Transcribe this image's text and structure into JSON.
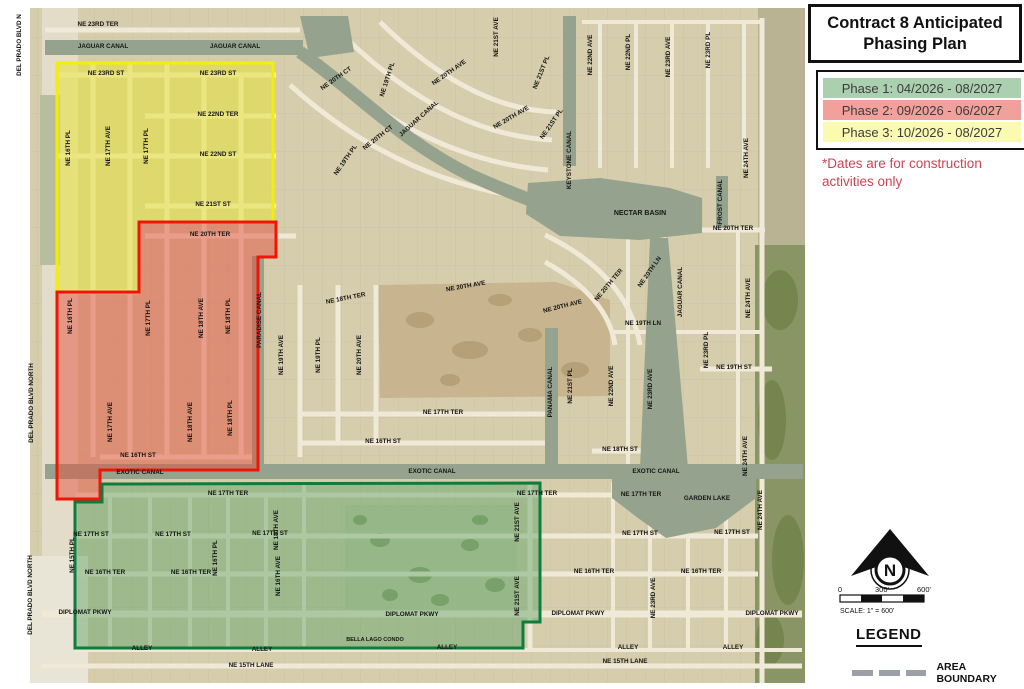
{
  "title": {
    "line1": "Contract 8 Anticipated",
    "line2": "Phasing Plan"
  },
  "phases": [
    {
      "label": "Phase 1: 04/2026 - 08/2027",
      "color": "#abd0af"
    },
    {
      "label": "Phase 2: 09/2026 - 06/2027",
      "color": "#f2a09c"
    },
    {
      "label": "Phase 3: 10/2026 - 08/2027",
      "color": "#fafab0"
    }
  ],
  "note": {
    "line1": "*Dates are for construction",
    "line2": "activities only",
    "color": "#cc4455"
  },
  "compass": {
    "letter": "N"
  },
  "scale": {
    "tick0": "0",
    "tick1": "300'",
    "tick2": "600'",
    "caption": "SCALE: 1\" = 600'"
  },
  "legend": {
    "heading": "LEGEND",
    "area_boundary": "AREA BOUNDARY"
  },
  "map": {
    "colors": {
      "base": "#d5cdab",
      "road": "#f0e9d7",
      "water": "#95a28d",
      "label": "#151515",
      "grid": "#c9c0a2"
    },
    "terrain": [
      {
        "t": "rect",
        "x": 42,
        "y": 8,
        "w": 36,
        "h": 675,
        "f": "#e3dcc8"
      },
      {
        "t": "rect",
        "x": 40,
        "y": 95,
        "w": 20,
        "h": 170,
        "f": "#b7bd9f"
      },
      {
        "t": "rect",
        "x": 30,
        "y": 556,
        "w": 58,
        "h": 127,
        "f": "#e8e4d6"
      },
      {
        "t": "rect",
        "x": 758,
        "y": 8,
        "w": 47,
        "h": 675,
        "f": "#b9b394"
      },
      {
        "t": "rect",
        "x": 755,
        "y": 245,
        "w": 50,
        "h": 438,
        "f": "#8a9565"
      },
      {
        "t": "ell",
        "x": 780,
        "y": 300,
        "rx": 18,
        "ry": 30,
        "f": "#75854e"
      },
      {
        "t": "ell",
        "x": 772,
        "y": 420,
        "rx": 14,
        "ry": 40,
        "f": "#75854e"
      },
      {
        "t": "ell",
        "x": 788,
        "y": 560,
        "rx": 16,
        "ry": 45,
        "f": "#75854e"
      },
      {
        "t": "ell",
        "x": 770,
        "y": 640,
        "rx": 14,
        "ry": 25,
        "f": "#75854e"
      },
      {
        "t": "poly",
        "p": "378,285 556,282 610,300 610,396 380,398",
        "f": "#c8b48e"
      },
      {
        "t": "ell",
        "x": 420,
        "y": 320,
        "rx": 14,
        "ry": 8,
        "f": "#b5a078"
      },
      {
        "t": "ell",
        "x": 470,
        "y": 350,
        "rx": 18,
        "ry": 9,
        "f": "#b5a078"
      },
      {
        "t": "ell",
        "x": 530,
        "y": 335,
        "rx": 12,
        "ry": 7,
        "f": "#b5a078"
      },
      {
        "t": "ell",
        "x": 575,
        "y": 370,
        "rx": 14,
        "ry": 8,
        "f": "#b5a078"
      },
      {
        "t": "ell",
        "x": 450,
        "y": 380,
        "rx": 10,
        "ry": 6,
        "f": "#b5a078"
      },
      {
        "t": "ell",
        "x": 500,
        "y": 300,
        "rx": 12,
        "ry": 6,
        "f": "#b5a078"
      },
      {
        "t": "rect",
        "x": 345,
        "y": 505,
        "w": 172,
        "h": 105,
        "f": "#c6c8a4"
      },
      {
        "t": "ell",
        "x": 380,
        "y": 540,
        "rx": 10,
        "ry": 7,
        "f": "#8ea06e"
      },
      {
        "t": "ell",
        "x": 420,
        "y": 575,
        "rx": 12,
        "ry": 8,
        "f": "#8ea06e"
      },
      {
        "t": "ell",
        "x": 470,
        "y": 545,
        "rx": 9,
        "ry": 6,
        "f": "#8ea06e"
      },
      {
        "t": "ell",
        "x": 390,
        "y": 595,
        "rx": 8,
        "ry": 6,
        "f": "#8ea06e"
      },
      {
        "t": "ell",
        "x": 495,
        "y": 585,
        "rx": 10,
        "ry": 7,
        "f": "#8ea06e"
      },
      {
        "t": "ell",
        "x": 360,
        "y": 520,
        "rx": 7,
        "ry": 5,
        "f": "#8ea06e"
      },
      {
        "t": "ell",
        "x": 440,
        "y": 600,
        "rx": 9,
        "ry": 6,
        "f": "#8ea06e"
      },
      {
        "t": "ell",
        "x": 480,
        "y": 520,
        "rx": 8,
        "ry": 5,
        "f": "#8ea06e"
      }
    ],
    "water": [
      {
        "t": "rect",
        "x": 45,
        "y": 40,
        "w": 258,
        "h": 15
      },
      {
        "t": "poly",
        "p": "300,16 348,16 354,52 310,58"
      },
      {
        "t": "path",
        "d": "M300,52 C360,95 400,140 470,175 C510,193 538,203 562,212",
        "sw": 13
      },
      {
        "t": "rect",
        "x": 563,
        "y": 16,
        "w": 13,
        "h": 150
      },
      {
        "t": "poly",
        "p": "528,183 600,178 670,188 702,198 702,233 640,240 560,236 526,214"
      },
      {
        "t": "rect",
        "x": 716,
        "y": 176,
        "w": 12,
        "h": 52
      },
      {
        "t": "poly",
        "p": "650,238 668,238 688,468 640,468"
      },
      {
        "t": "rect",
        "x": 545,
        "y": 328,
        "w": 13,
        "h": 142
      },
      {
        "t": "rect",
        "x": 252,
        "y": 256,
        "w": 12,
        "h": 214
      },
      {
        "t": "rect",
        "x": 45,
        "y": 464,
        "w": 758,
        "h": 15
      },
      {
        "t": "poly",
        "p": "612,479 756,479 756,498 716,528 666,538 638,518 612,498"
      }
    ],
    "roads": {
      "h": [
        [
          30,
          45,
          300
        ],
        [
          75,
          57,
          276
        ],
        [
          116,
          145,
          276
        ],
        [
          156,
          57,
          276
        ],
        [
          206,
          145,
          276
        ],
        [
          236,
          145,
          296
        ],
        [
          292,
          57,
          139
        ],
        [
          457,
          100,
          258
        ],
        [
          495,
          75,
          668
        ],
        [
          536,
          75,
          758
        ],
        [
          574,
          75,
          758
        ],
        [
          614,
          42,
          802,
          7
        ],
        [
          650,
          75,
          802,
          4
        ],
        [
          666,
          42,
          802
        ],
        [
          443,
          298,
          545
        ],
        [
          414,
          298,
          545
        ],
        [
          369,
          700,
          772
        ],
        [
          451,
          592,
          658
        ],
        [
          230,
          700,
          765
        ],
        [
          22,
          582,
          760,
          4
        ],
        [
          332,
          613,
          762,
          4
        ]
      ],
      "v": [
        [
          93,
          63,
          457
        ],
        [
          130,
          63,
          457
        ],
        [
          167,
          63,
          457
        ],
        [
          204,
          75,
          457
        ],
        [
          241,
          75,
          457
        ],
        [
          300,
          285,
          457
        ],
        [
          338,
          285,
          443
        ],
        [
          376,
          285,
          443
        ],
        [
          110,
          495,
          648,
          4
        ],
        [
          150,
          495,
          648,
          4
        ],
        [
          190,
          495,
          648,
          4
        ],
        [
          228,
          495,
          648,
          4
        ],
        [
          266,
          495,
          648,
          4
        ],
        [
          304,
          482,
          648,
          4
        ],
        [
          530,
          482,
          650
        ],
        [
          613,
          482,
          650,
          4
        ],
        [
          650,
          482,
          650,
          4
        ],
        [
          688,
          482,
          650,
          4
        ],
        [
          726,
          482,
          650,
          4
        ],
        [
          600,
          22,
          168,
          4
        ],
        [
          636,
          22,
          168,
          4
        ],
        [
          672,
          22,
          168,
          4
        ],
        [
          708,
          22,
          168,
          4
        ],
        [
          744,
          22,
          168,
          4
        ],
        [
          628,
          230,
          466,
          4
        ],
        [
          664,
          230,
          466,
          4
        ],
        [
          738,
          230,
          466,
          4
        ],
        [
          762,
          18,
          683,
          5
        ]
      ],
      "d": [
        "M290,85 Q400,185 545,200",
        "M318,62 Q425,160 548,170",
        "M348,40 Q448,135 552,140",
        "M380,22 Q470,110 556,112",
        "M545,235 Q628,275 640,345",
        "M545,262 Q608,297 615,345"
      ]
    },
    "zones": [
      {
        "name": "phase3-yellow",
        "path": "M57,63 L273,63 L273,222 L139,222 L139,292 L57,292 Z",
        "fill": "#e8e33a",
        "op": 0.55,
        "stroke": "#f4ef00"
      },
      {
        "name": "phase2-red",
        "path": "M139,222 L276,222 L276,257 L258,257 L258,470 L100,470 L100,499 L57,499 L57,292 L139,292 Z",
        "fill": "#e4523f",
        "op": 0.5,
        "stroke": "#f01505"
      },
      {
        "name": "phase1-green",
        "path": "M102,484 L540,483 L540,622 L523,622 L523,648 L75,648 L75,502 L102,502 Z",
        "fill": "#5aa263",
        "op": 0.45,
        "stroke": "#0e7c3f"
      }
    ],
    "labels": [
      [
        "NE 23RD TER",
        98,
        26
      ],
      [
        "JAGUAR CANAL",
        103,
        48
      ],
      [
        "JAGUAR CANAL",
        235,
        48
      ],
      [
        "NE 23RD ST",
        106,
        75
      ],
      [
        "NE 23RD ST",
        218,
        75
      ],
      [
        "NE 22ND TER",
        218,
        116
      ],
      [
        "NE 22ND ST",
        218,
        156
      ],
      [
        "NE 21ST ST",
        213,
        206
      ],
      [
        "NE 20TH TER",
        210,
        236
      ],
      [
        "NE 20TH TER",
        733,
        230
      ],
      [
        "NECTAR BASIN",
        640,
        215,
        0,
        7
      ],
      [
        "NE 16TH ST",
        138,
        457
      ],
      [
        "EXOTIC CANAL",
        140,
        474
      ],
      [
        "EXOTIC CANAL",
        432,
        473
      ],
      [
        "EXOTIC CANAL",
        656,
        473
      ],
      [
        "NE 17TH TER",
        228,
        495
      ],
      [
        "NE 17TH TER",
        537,
        495
      ],
      [
        "NE 17TH TER",
        641,
        496
      ],
      [
        "NE 17TH ST",
        91,
        536
      ],
      [
        "NE 17TH ST",
        173,
        536
      ],
      [
        "NE 17TH ST",
        270,
        535
      ],
      [
        "NE 17TH ST",
        640,
        535
      ],
      [
        "NE 17TH ST",
        732,
        534
      ],
      [
        "NE 16TH TER",
        105,
        574
      ],
      [
        "NE 16TH TER",
        191,
        574
      ],
      [
        "NE 16TH TER",
        594,
        573
      ],
      [
        "NE 16TH TER",
        701,
        573
      ],
      [
        "DIPLOMAT PKWY",
        85,
        614
      ],
      [
        "DIPLOMAT PKWY",
        412,
        616
      ],
      [
        "DIPLOMAT PKWY",
        578,
        615
      ],
      [
        "DIPLOMAT PKWY",
        772,
        615
      ],
      [
        "ALLEY",
        142,
        650
      ],
      [
        "ALLEY",
        262,
        651
      ],
      [
        "ALLEY",
        447,
        649
      ],
      [
        "ALLEY",
        628,
        649
      ],
      [
        "ALLEY",
        733,
        649
      ],
      [
        "NE 15TH LANE",
        251,
        667
      ],
      [
        "NE 15TH LANE",
        625,
        663
      ],
      [
        "BELLA LAGO CONDO",
        375,
        641,
        0,
        5.5
      ],
      [
        "GARDEN LAKE",
        707,
        500
      ],
      [
        "NE 19TH ST",
        734,
        369
      ],
      [
        "NE 18TH ST",
        620,
        451
      ],
      [
        "NE 16TH ST",
        383,
        443
      ],
      [
        "NE 17TH TER",
        443,
        414
      ],
      [
        "NE 19TH LN",
        643,
        325
      ],
      [
        "NE 20TH CT",
        337,
        80,
        -35
      ],
      [
        "NE 20TH CT",
        379,
        139,
        -38
      ],
      [
        "NE 19TH PL",
        389,
        80,
        -72
      ],
      [
        "NE 19TH PL",
        347,
        161,
        -55
      ],
      [
        "NE 20TH AVE",
        450,
        74,
        -35
      ],
      [
        "NE 20TH AVE",
        512,
        119,
        -30
      ],
      [
        "JAGUAR CANAL",
        420,
        120,
        -42
      ],
      [
        "NE 18TH TER",
        346,
        300,
        -11
      ],
      [
        "NE 20TH AVE",
        466,
        288,
        -10
      ],
      [
        "NE 20TH AVE",
        563,
        308,
        -14
      ],
      [
        "NE 20TH LN",
        651,
        273,
        -55
      ],
      [
        "NE 20TH TER",
        610,
        286,
        -50
      ],
      [
        "DEL PRADO BLVD N",
        21,
        45,
        -90
      ],
      [
        "DEL PRADO BLVD NORTH",
        33,
        403,
        -90
      ],
      [
        "DEL PRADO BLVD NORTH",
        32,
        595,
        -90
      ],
      [
        "NE 16TH PL",
        70,
        148,
        -90
      ],
      [
        "NE 17TH AVE",
        110,
        146,
        -90
      ],
      [
        "NE 17TH PL",
        148,
        146,
        -90
      ],
      [
        "NE 16TH PL",
        72,
        316,
        -90
      ],
      [
        "NE 17TH PL",
        150,
        318,
        -90
      ],
      [
        "NE 18TH AVE",
        203,
        318,
        -90
      ],
      [
        "NE 18TH PL",
        230,
        316,
        -90
      ],
      [
        "NE 17TH AVE",
        112,
        422,
        -90
      ],
      [
        "NE 18TH AVE",
        192,
        422,
        -90
      ],
      [
        "NE 18TH PL",
        232,
        418,
        -90
      ],
      [
        "PARADISE CANAL",
        261,
        320,
        -90
      ],
      [
        "NE 19TH AVE",
        283,
        355,
        -90
      ],
      [
        "NE 19TH PL",
        320,
        355,
        -90
      ],
      [
        "NE 20TH AVE",
        361,
        355,
        -90
      ],
      [
        "PANAMA CANAL",
        552,
        392,
        -90
      ],
      [
        "NE 21ST PL",
        572,
        386,
        -90
      ],
      [
        "NE 22ND AVE",
        613,
        386,
        -90
      ],
      [
        "NE 23RD AVE",
        652,
        389,
        -90
      ],
      [
        "NE 23RD PL",
        708,
        350,
        -90
      ],
      [
        "NE 24TH AVE",
        750,
        298,
        -90
      ],
      [
        "NE 24TH AVE",
        748,
        158,
        -90
      ],
      [
        "NE 24TH AVE",
        747,
        456,
        -90
      ],
      [
        "JAGUAR CANAL",
        682,
        292,
        -90
      ],
      [
        "FROST CANAL",
        722,
        202,
        -90
      ],
      [
        "KEYSTONE CANAL",
        571,
        160,
        -90
      ],
      [
        "NE 21ST AVE",
        498,
        37,
        -90
      ],
      [
        "NE 21ST PL",
        543,
        73,
        -68
      ],
      [
        "NE 21ST PL",
        553,
        125,
        -55
      ],
      [
        "NE 22ND AVE",
        592,
        55,
        -90
      ],
      [
        "NE 22ND PL",
        630,
        52,
        -90
      ],
      [
        "NE 23RD AVE",
        670,
        57,
        -90
      ],
      [
        "NE 23RD PL",
        710,
        50,
        -90
      ],
      [
        "NE 15TH PL",
        74,
        555,
        -90
      ],
      [
        "NE 16TH PL",
        217,
        558,
        -90
      ],
      [
        "NE 16TH AVE",
        280,
        576,
        -90
      ],
      [
        "NE 18TH AVE",
        278,
        530,
        -90
      ],
      [
        "NE 21ST AVE",
        519,
        522,
        -90
      ],
      [
        "NE 21ST AVE",
        519,
        596,
        -90
      ],
      [
        "NE 23RD AVE",
        655,
        598,
        -90
      ],
      [
        "NE 24TH AVE",
        762,
        510,
        -90
      ]
    ]
  }
}
